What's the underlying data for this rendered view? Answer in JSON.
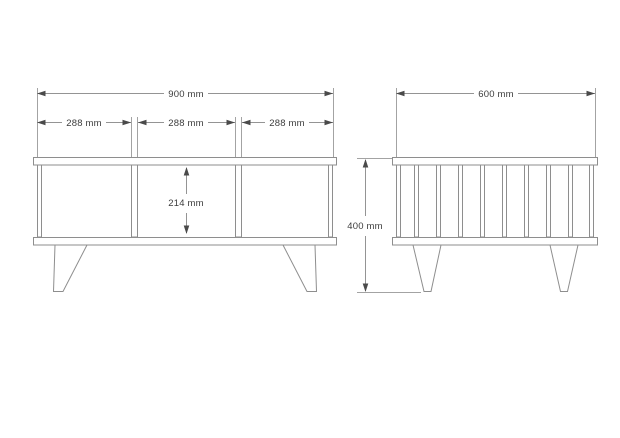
{
  "drawing": {
    "front_view": {
      "overall_width": "900 mm",
      "sections": [
        "288 mm",
        "288 mm",
        "288 mm"
      ],
      "opening_height": "214 mm"
    },
    "side_view": {
      "depth": "600 mm",
      "height": "400 mm"
    },
    "colors": {
      "background": "#ffffff",
      "line": "#949494",
      "arrow": "#4a4a4a",
      "text": "#3d3d3d"
    }
  }
}
